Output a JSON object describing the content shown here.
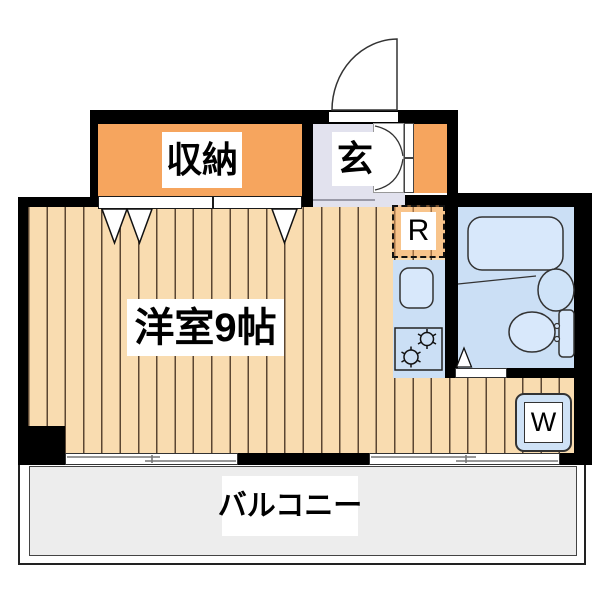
{
  "floorplan": {
    "rooms": {
      "storage_label": "収納",
      "entrance_label": "玄",
      "main_room_label": "洋室9帖",
      "balcony_label": "バルコニー",
      "refrigerator_label": "R",
      "washer_label": "W"
    },
    "colors": {
      "wall": "#000000",
      "wood_floor": "#f9dcb0",
      "wood_floor_line": "#5b4632",
      "storage_orange": "#f6a55e",
      "entrance_gray": "#e2e2ee",
      "water_area_blue": "#cbdff5",
      "fixture_blue": "#d8e8fb",
      "balcony_gray": "#ededed"
    }
  }
}
